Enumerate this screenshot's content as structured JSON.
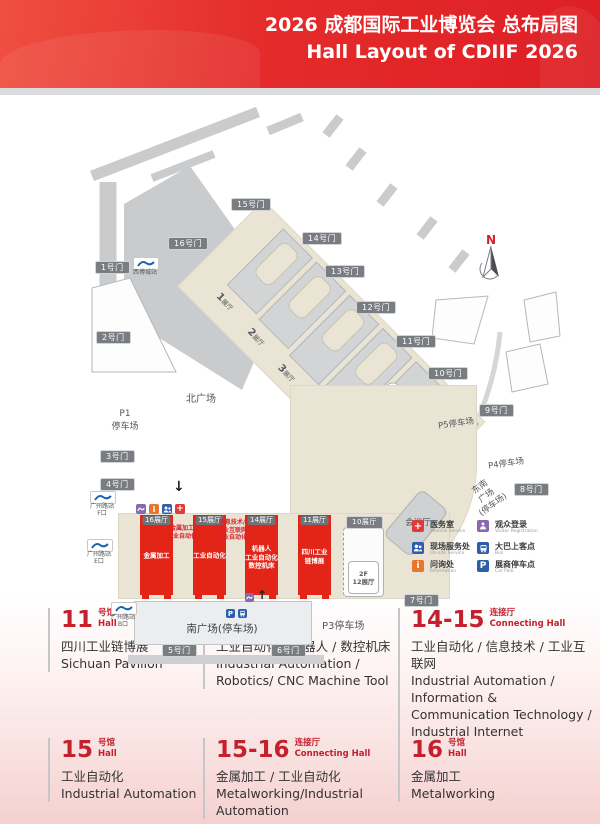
{
  "header": {
    "title": "2026 成都国际工业博览会 总布局图\nHall Layout of CDIIF 2026"
  },
  "colors": {
    "header_red": "#e42b2a",
    "hall_red": "#e32518",
    "accent_red": "#c4202e",
    "building_beige": "#e9e4d3",
    "road_gray": "#c9cbcd"
  },
  "map": {
    "north_label": "N",
    "gates": [
      {
        "label": "1号门"
      },
      {
        "label": "2号门"
      },
      {
        "label": "3号门"
      },
      {
        "label": "4号门"
      },
      {
        "label": "5号门"
      },
      {
        "label": "6号门"
      },
      {
        "label": "7号门"
      },
      {
        "label": "8号门"
      },
      {
        "label": "9号门"
      },
      {
        "label": "10号门"
      },
      {
        "label": "11号门"
      },
      {
        "label": "12号门"
      },
      {
        "label": "13号门"
      },
      {
        "label": "14号门"
      },
      {
        "label": "15号门"
      },
      {
        "label": "16号门"
      }
    ],
    "halls": [
      {
        "num": "1",
        "suffix": "展厅"
      },
      {
        "num": "2",
        "suffix": "展厅"
      },
      {
        "num": "3",
        "suffix": "展厅"
      },
      {
        "num": "4",
        "suffix": "展厅"
      },
      {
        "num": "5",
        "suffix": "展厅"
      },
      {
        "num": "6",
        "suffix": "展厅"
      }
    ],
    "f2_halls": {
      "h7": "2F\n7展厅",
      "h8": "2F\n8展厅",
      "h12": "2F\n12展厅"
    },
    "hall10_tag": "10展厅",
    "red_halls": [
      {
        "tag": "16展厅",
        "content": "金属加工"
      },
      {
        "tag": "15展厅",
        "content": "工业自动化"
      },
      {
        "tag": "14展厅",
        "content": "机器人\n工业自动化\n数控机床"
      },
      {
        "tag": "11展厅",
        "content": "四川工业\n链博展"
      }
    ],
    "connectors": [
      {
        "content": "金属加工\n工业自动化"
      },
      {
        "content": "信息技术/\n工业互联网\n工业自动化"
      }
    ],
    "areas": {
      "north_plaza": "北广场",
      "p1": "P1\n停车场",
      "south_plaza": "南广场(停车场)",
      "p3": "P3停车场",
      "p4": "P4停车场",
      "p5": "P5停车场",
      "southeast_plaza": "东南\n广场\n(停车场)",
      "conference": "会议厅"
    },
    "metro_stations": [
      {
        "label": "西博城站"
      },
      {
        "label": "广州路站\nF口"
      },
      {
        "label": "广州路站\nE口"
      },
      {
        "label": "广州路站\nB口"
      }
    ]
  },
  "icons": {
    "medical": "+",
    "info": "i",
    "parking": "P",
    "arrow_down": "↓",
    "arrow_up": "↑"
  },
  "services": [
    {
      "zh": "医务室",
      "en": "Medical Service",
      "color": "#e03a36"
    },
    {
      "zh": "现场服务处",
      "en": "On-site Service",
      "color": "#2f5da8"
    },
    {
      "zh": "问询处",
      "en": "Information",
      "color": "#e8762a"
    },
    {
      "zh": "观众登录",
      "en": "Visitor Registration",
      "color": "#8a68ad"
    },
    {
      "zh": "大巴上客点",
      "en": "Bus",
      "color": "#2f5da8"
    },
    {
      "zh": "展商停车点",
      "en": "Car Park",
      "color": "#2f5da8"
    }
  ],
  "info_blocks": [
    {
      "num": "11",
      "type": "号馆\nHall",
      "zh": "四川工业链博展",
      "en": "Sichuan Pavilion"
    },
    {
      "num": "14",
      "type": "号馆\nHall",
      "zh": "工业自动化 / 机器人 / 数控机床",
      "en": "Industrial Automation / Robotics/ CNC Machine Tool"
    },
    {
      "num": "14-15",
      "type": "连接厅\nConnecting Hall",
      "zh": "工业自动化 / 信息技术 / 工业互联网",
      "en": "Industrial Automation / Information & Communication Technology / Industrial Internet"
    },
    {
      "num": "15",
      "type": "号馆\nHall",
      "zh": "工业自动化",
      "en": "Industrial Automation"
    },
    {
      "num": "15-16",
      "type": "连接厅\nConnecting Hall",
      "zh": "金属加工 / 工业自动化",
      "en": "Metalworking/Industrial Automation"
    },
    {
      "num": "16",
      "type": "号馆\nHall",
      "zh": "金属加工",
      "en": "Metalworking"
    }
  ]
}
